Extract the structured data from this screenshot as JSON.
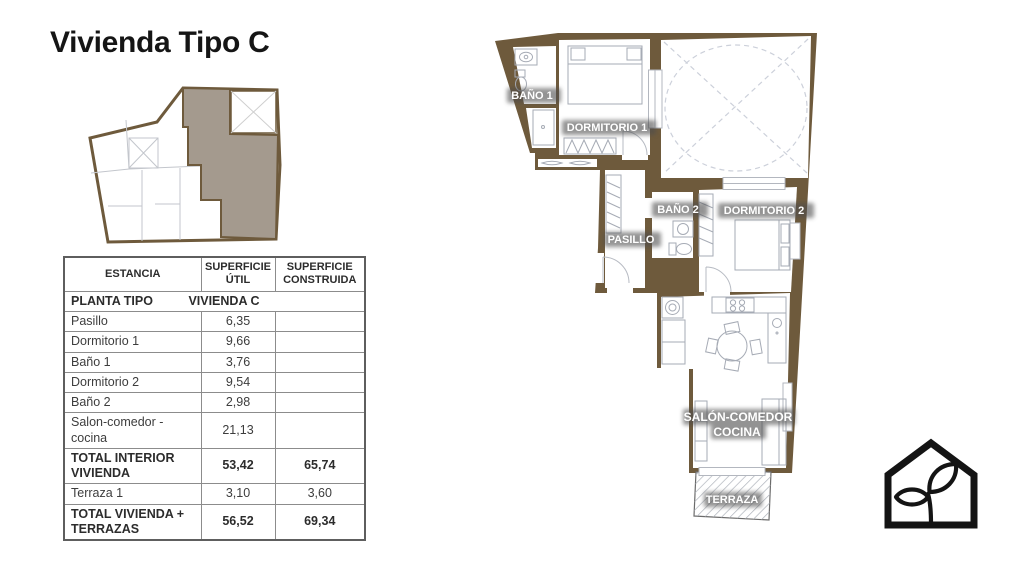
{
  "page": {
    "title": "Vivienda Tipo C"
  },
  "colors": {
    "wall_brown": "#6e5a3c",
    "unit_highlight": "#a49a8e",
    "logo_black": "#141414"
  },
  "table": {
    "headers": [
      "ESTANCIA",
      "SUPERFICIE ÚTIL",
      "SUPERFICIE CONSTRUIDA"
    ],
    "section": {
      "left": "PLANTA TIPO",
      "right": "VIVIENDA C"
    },
    "rows": [
      {
        "estancia": "Pasillo",
        "util": "6,35",
        "construida": "",
        "bold": false
      },
      {
        "estancia": "Dormitorio 1",
        "util": "9,66",
        "construida": "",
        "bold": false
      },
      {
        "estancia": "Baño 1",
        "util": "3,76",
        "construida": "",
        "bold": false
      },
      {
        "estancia": "Dormitorio 2",
        "util": "9,54",
        "construida": "",
        "bold": false
      },
      {
        "estancia": "Baño 2",
        "util": "2,98",
        "construida": "",
        "bold": false
      },
      {
        "estancia": "Salon-comedor - cocina",
        "util": "21,13",
        "construida": "",
        "bold": false
      },
      {
        "estancia": "TOTAL INTERIOR VIVIENDA",
        "util": "53,42",
        "construida": "65,74",
        "bold": true
      },
      {
        "estancia": "Terraza 1",
        "util": "3,10",
        "construida": "3,60",
        "bold": false
      },
      {
        "estancia": "TOTAL VIVIENDA + TERRAZAS",
        "util": "56,52",
        "construida": "69,34",
        "bold": true
      }
    ]
  },
  "floorplan": {
    "labels": {
      "bano1": "BAÑO 1",
      "dormitorio1": "DORMITORIO 1",
      "bano2": "BAÑO 2",
      "dormitorio2": "DORMITORIO 2",
      "pasillo": "PASILLO",
      "salon_line1": "SALÓN-COMEDOR",
      "salon_line2": "COCINA",
      "terraza": "TERRAZA"
    }
  }
}
